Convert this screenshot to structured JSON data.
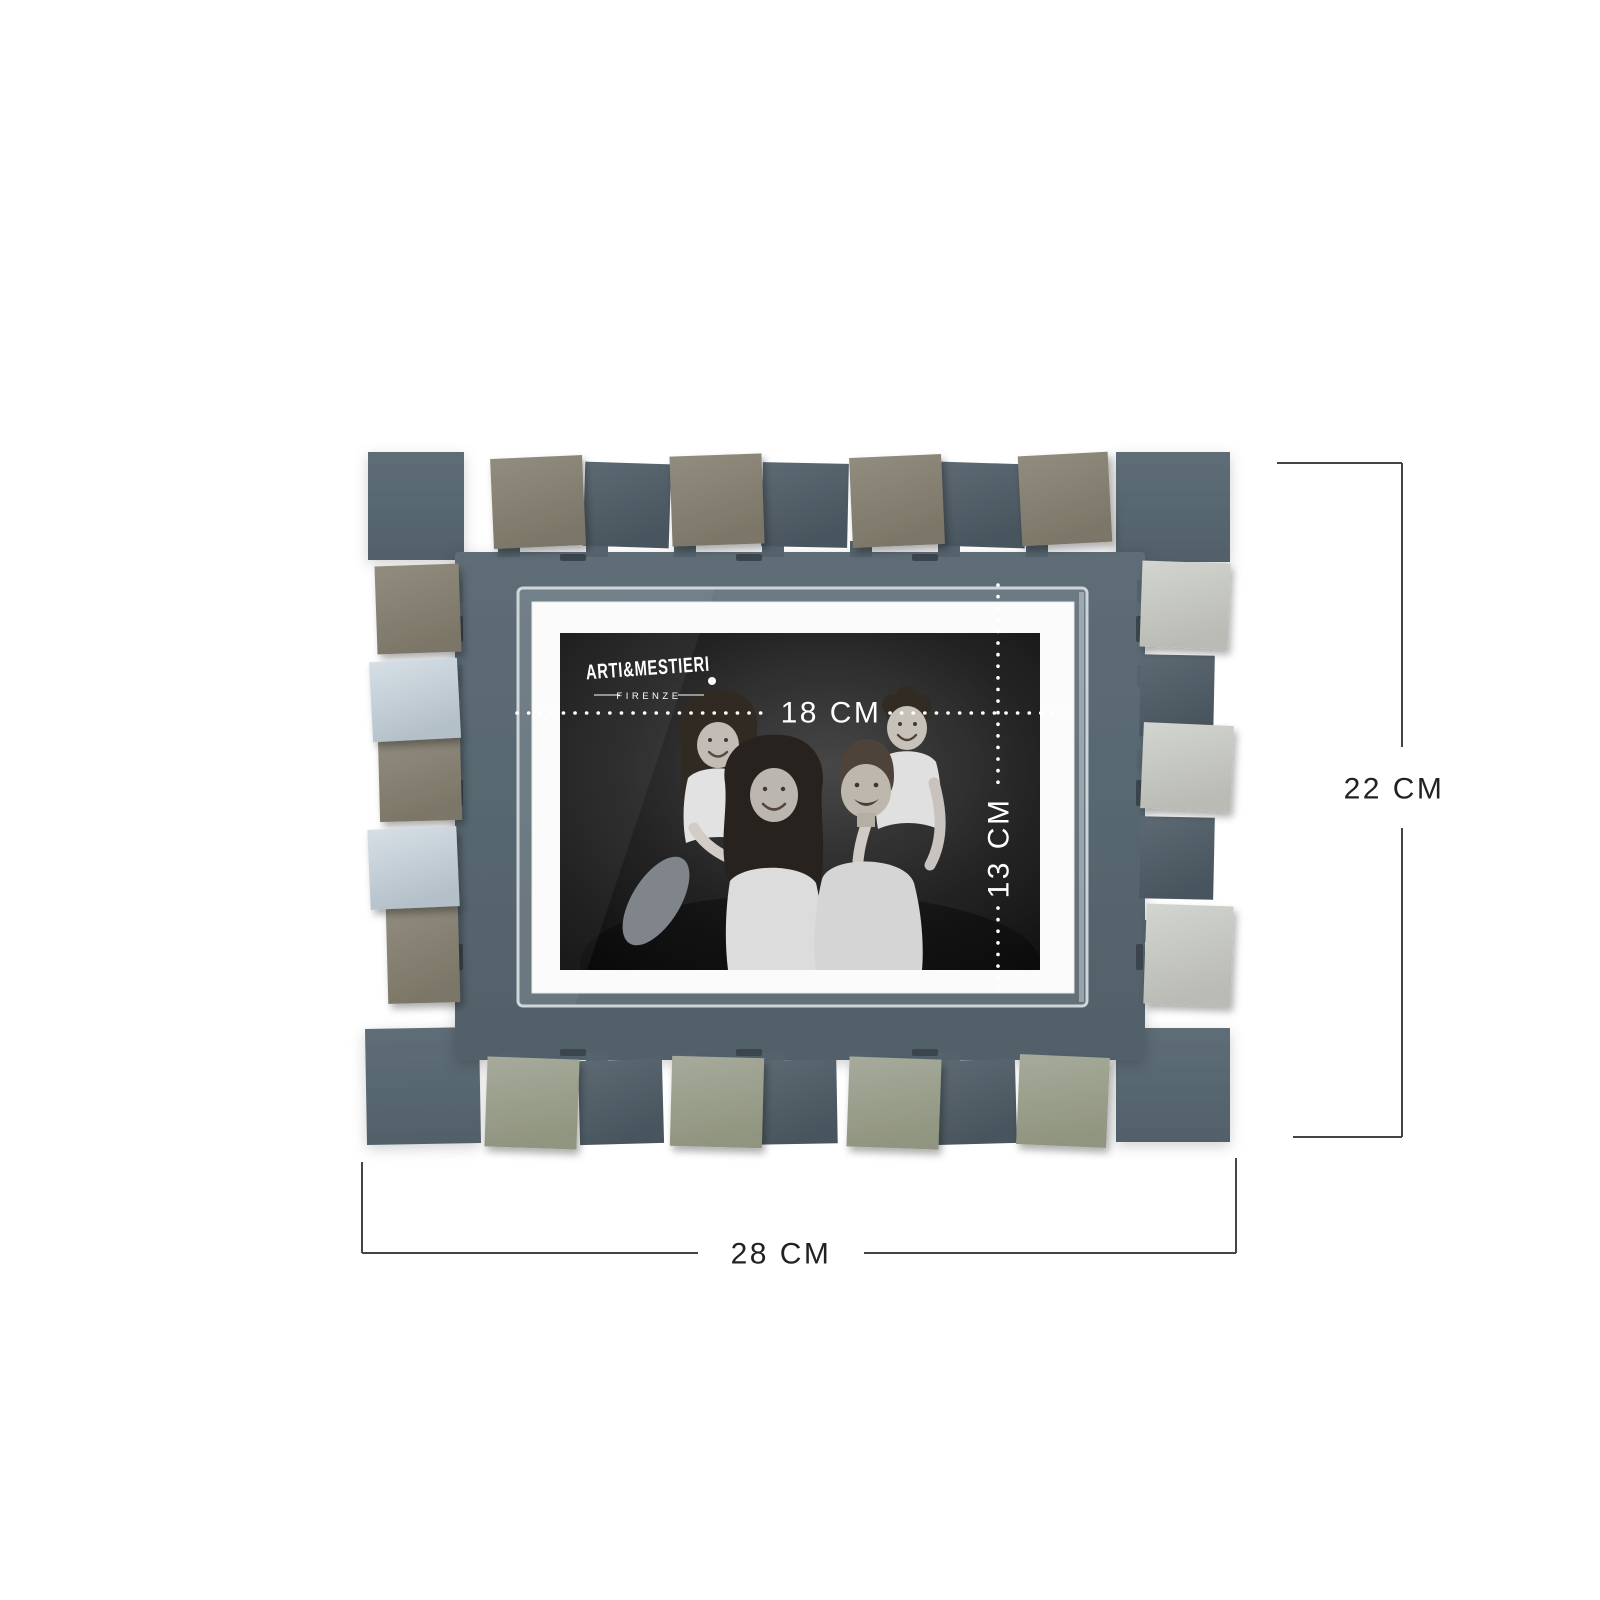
{
  "brand": {
    "name": "ARTI&MESTIERI",
    "subtitle": "FIRENZE"
  },
  "dimension_labels": {
    "frame_width": "28 CM",
    "frame_height": "22 CM",
    "photo_width": "18 CM",
    "photo_height": "13 CM"
  },
  "colors": {
    "background": "#ffffff",
    "frame_slate": "#5b6a74",
    "frame_slate_dark": "#53616b",
    "square_slate": "#57646d",
    "square_taupe": "#89postfix",
    "square_taupe_fixed": "#89викон",
    "taupe": "#8a8477",
    "taupe_dark": "#78725f",
    "silver": "#c8cac4",
    "silver_blue": "#cad4db",
    "sage": "#9ea294",
    "mat_white": "#fbfbfb",
    "photo_background": "#161616",
    "dimension_line": "#454545",
    "dimension_text": "#222222",
    "annotation_white": "#ffffff"
  }
}
